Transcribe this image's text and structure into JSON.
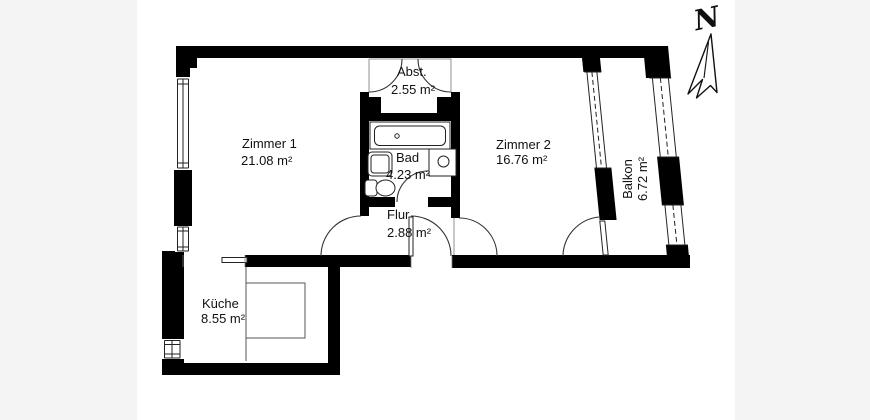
{
  "compass": {
    "label": "N"
  },
  "rooms": [
    {
      "id": "zimmer1",
      "name": "Zimmer 1",
      "area": "21.08 m²"
    },
    {
      "id": "zimmer2",
      "name": "Zimmer 2",
      "area": "16.76 m²"
    },
    {
      "id": "abstellraum",
      "name": "Abst.",
      "area": "2.55 m²"
    },
    {
      "id": "bad",
      "name": "Bad",
      "area": "4.23 m²"
    },
    {
      "id": "flur",
      "name": "Flur",
      "area": "2.88 m²"
    },
    {
      "id": "kueche",
      "name": "Küche",
      "area": "8.55 m²"
    },
    {
      "id": "balkon",
      "name": "Balkon",
      "area": "6.72 m²"
    }
  ],
  "colors": {
    "wall": "#000000",
    "floor": "#ffffff",
    "background": "#f4f4f4",
    "line": "#222222",
    "text": "#111111"
  }
}
